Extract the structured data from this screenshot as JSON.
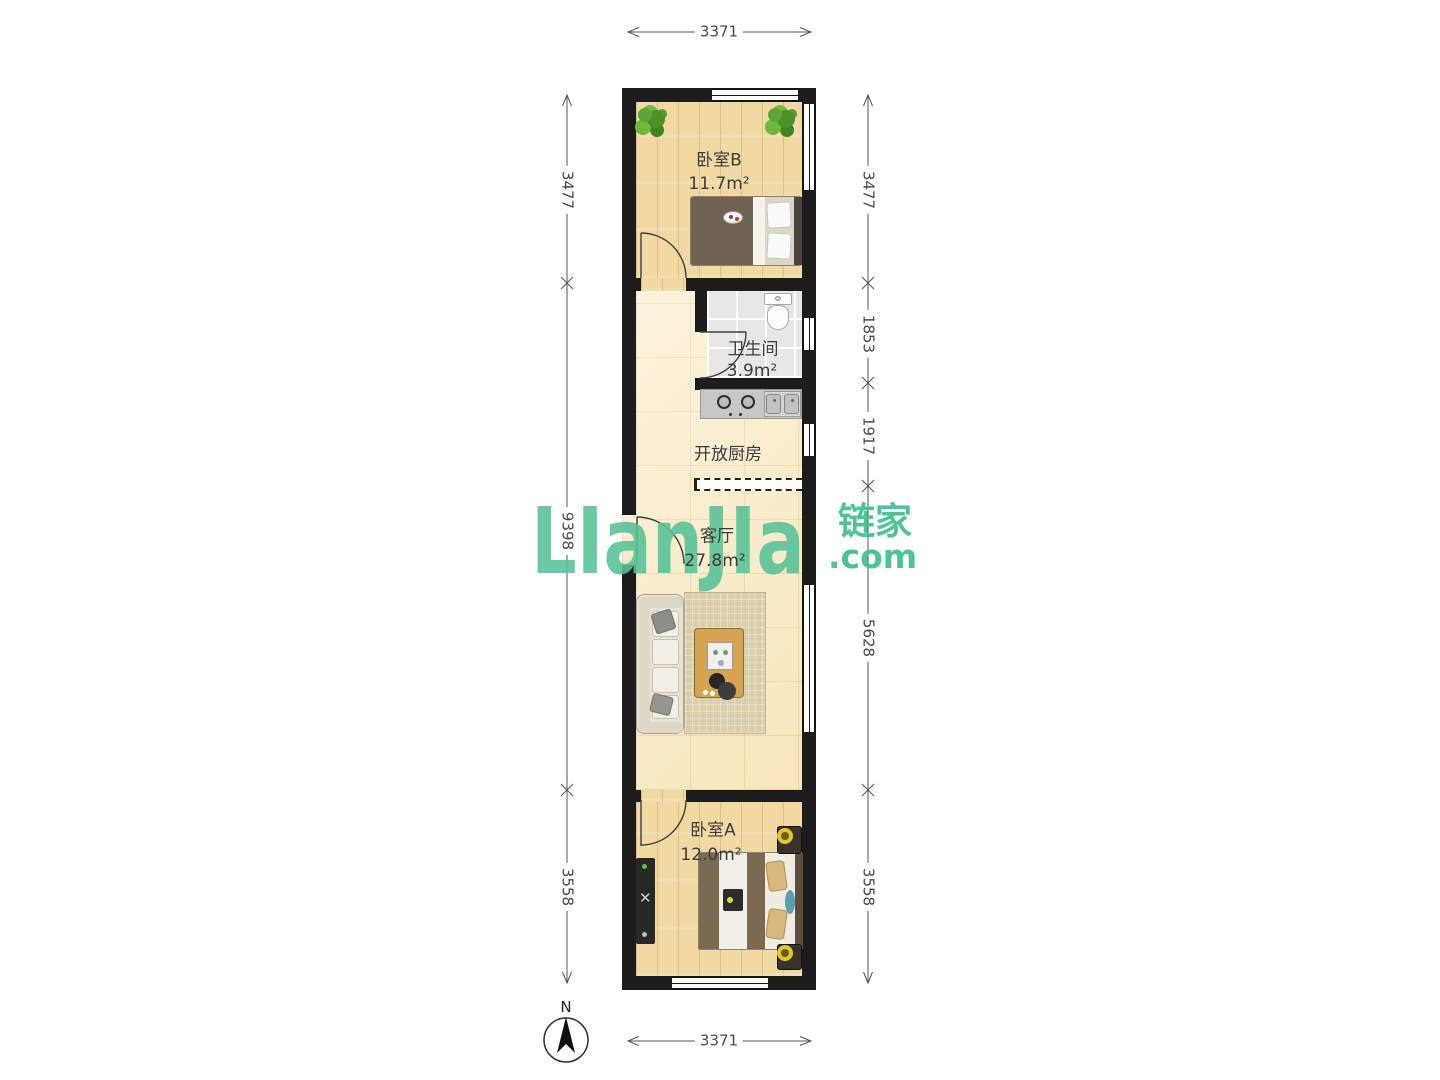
{
  "brand": {
    "logo_text": "LIanJIa",
    "brand_cn": "链家",
    "brand_domain": ".com",
    "brand_green": "#3fbf8e"
  },
  "compass": {
    "north_label": "N"
  },
  "dimensions": {
    "top": "3371",
    "bottom": "3371",
    "left": [
      "3477",
      "9398",
      "3558"
    ],
    "right": [
      "3477",
      "1853",
      "1917",
      "5628",
      "3558"
    ]
  },
  "rooms": {
    "bedroom_b": {
      "name": "卧室B",
      "area": "11.7m²"
    },
    "bathroom": {
      "name": "卫生间",
      "area": "3.9m²"
    },
    "open_kitchen": {
      "name": "开放厨房"
    },
    "living_room": {
      "name": "客厅",
      "area": "27.8m²"
    },
    "bedroom_a": {
      "name": "卧室A",
      "area": "12.0m²"
    }
  }
}
